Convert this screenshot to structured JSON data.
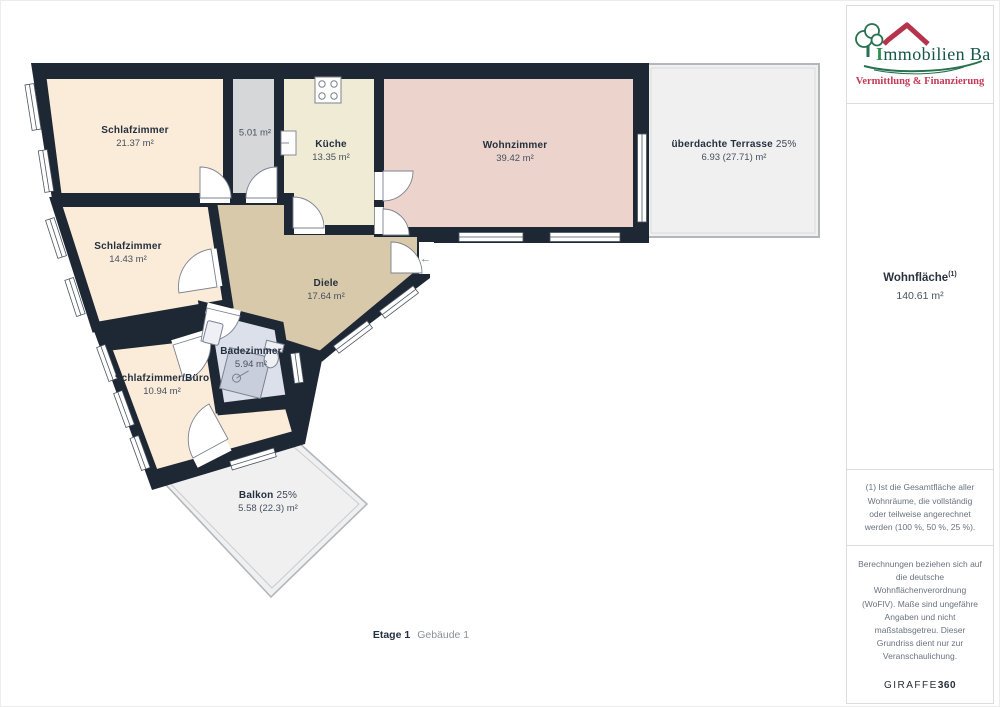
{
  "rooms": [
    {
      "name": "Schlafzimmer",
      "area": "21.37 m²"
    },
    {
      "name": "",
      "area": "5.01 m²"
    },
    {
      "name": "Küche",
      "area": "13.35 m²"
    },
    {
      "name": "Wohnzimmer",
      "area": "39.42 m²"
    },
    {
      "name": "überdachte Terrasse",
      "percent": "25%",
      "area": "6.93 (27.71) m²"
    },
    {
      "name": "Schlafzimmer",
      "area": "14.43 m²"
    },
    {
      "name": "Diele",
      "area": "17.64 m²"
    },
    {
      "name": "Badezimmer",
      "area": "5.94 m²"
    },
    {
      "name": "Schlafzimmer/Büro",
      "area": "10.94 m²"
    },
    {
      "name": "Balkon",
      "percent": "25%",
      "area": "5.58 (22.3) m²"
    }
  ],
  "footer": {
    "floor_label": "Etage 1",
    "building_label": "Gebäude 1"
  },
  "sidebar": {
    "logo": {
      "title_initial": "I",
      "title_rest": "mmobilien Bart",
      "subtitle": "Vermittlung & Finanzierung"
    },
    "total": {
      "label": "Wohnfläche",
      "footnote_ref": "(1)",
      "value": "140.61 m²"
    },
    "note1": "(1) Ist die Gesamtfläche aller Wohnräume, die vollständig oder teilweise angerechnet werden (100 %, 50 %, 25 %).",
    "note2": "Berechnungen beziehen sich auf die deutsche Wohnflächenverordnung (WoFlV). Maße sind ungefähre Angaben und nicht maßstabsgetreu. Dieser Grundriss dient nur zur Veranschaulichung.",
    "brand": {
      "name": "GIRAFFE",
      "suffix": "360"
    }
  },
  "icons": {
    "entrance_arrow": "←"
  },
  "colors": {
    "wall": "#1e2835",
    "bedroom": "#fbecd9",
    "storage": "#d5d7d9",
    "kitchen": "#f0ebd5",
    "living": "#ecd4cc",
    "hall": "#d8c9ab",
    "bath": "#dce0eb",
    "outdoor": "#f0f0f1",
    "outdoor_border": "#b4b7ba",
    "logo_green": "#27714f",
    "logo_text": "#17564a",
    "logo_red": "#c23a55"
  }
}
